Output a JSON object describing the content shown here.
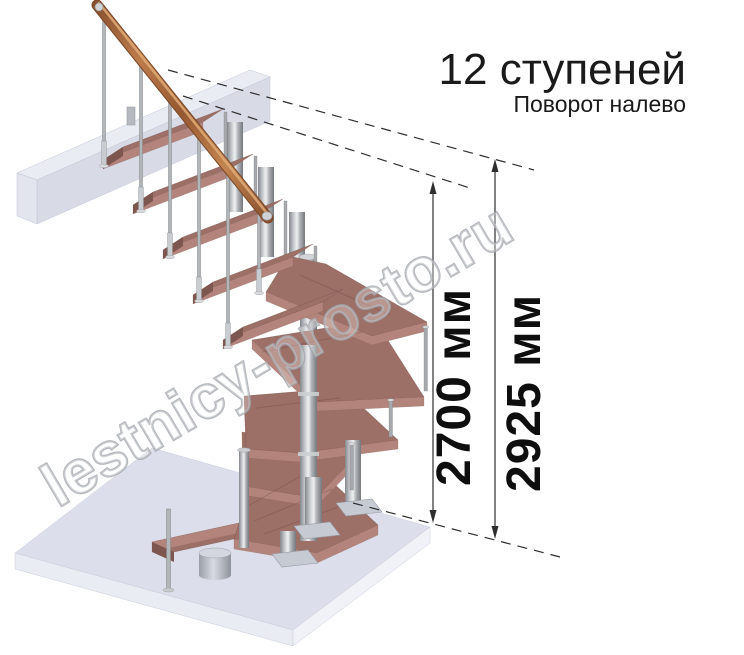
{
  "title": {
    "steps_label": "12 ступеней",
    "turn_label": "Поворот налево"
  },
  "dimensions": {
    "staircase_height": "2700 мм",
    "total_height": "2925 мм"
  },
  "watermark": {
    "text": "lestnicy-prosto.ru"
  },
  "colors": {
    "background": "#ffffff",
    "wood_top": "#9c6f67",
    "wood_front": "#b3847c",
    "wood_side": "#7d564f",
    "handrail_copper": "#bd7c4c",
    "metal": "#b3b6b9",
    "slab_lavender": "#dcdfeb",
    "dimension_ink": "#2e2e2e",
    "watermark_gray": "#a2a6ac",
    "title_ink": "#1a1a1a"
  }
}
